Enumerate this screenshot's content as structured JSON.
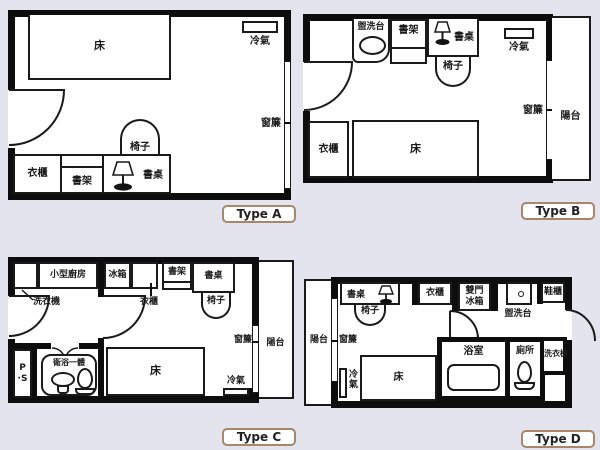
{
  "colors": {
    "background": "#e4e4ee",
    "wall": "#0d0d0d",
    "line": "#1a1a1a",
    "text": "#1a1a1a",
    "badge_border": "#a8866a"
  },
  "plans": {
    "a": {
      "badge": "Type A",
      "labels": {
        "bed": "床",
        "ac": "冷氣",
        "curtain": "窗簾",
        "chair": "椅子",
        "wardrobe": "衣櫃",
        "bookshelf": "書架",
        "desk": "書桌"
      }
    },
    "b": {
      "badge": "Type B",
      "labels": {
        "washbasin": "盥洗台",
        "bookshelf": "書架",
        "desk": "書桌",
        "chair": "椅子",
        "ac": "冷氣",
        "wardrobe": "衣櫃",
        "bed": "床",
        "curtain": "窗簾",
        "balcony": "陽台"
      }
    },
    "c": {
      "badge": "Type C",
      "labels": {
        "kitchen": "小型廚房",
        "fridge": "冰箱",
        "bookshelf": "書架",
        "desk": "書桌",
        "washer": "洗衣機",
        "wardrobe": "衣櫃",
        "chair": "椅子",
        "pipe_space": "P\n·S",
        "unit_bath": "衛浴一體",
        "bed": "床",
        "ac": "冷氣",
        "curtain": "窗簾",
        "balcony": "陽台"
      }
    },
    "d": {
      "badge": "Type D",
      "labels": {
        "balcony": "陽台",
        "desk": "書桌",
        "chair": "椅子",
        "wardrobe": "衣櫃",
        "double_door_fridge": "雙門\n冰箱",
        "washbasin": "盥洗台",
        "shoe_cabinet": "鞋櫃",
        "curtain": "窗簾",
        "ac": "冷\n氣",
        "bed": "床",
        "bathroom": "浴室",
        "toilet": "廁所",
        "washer": "洗衣機"
      }
    }
  }
}
